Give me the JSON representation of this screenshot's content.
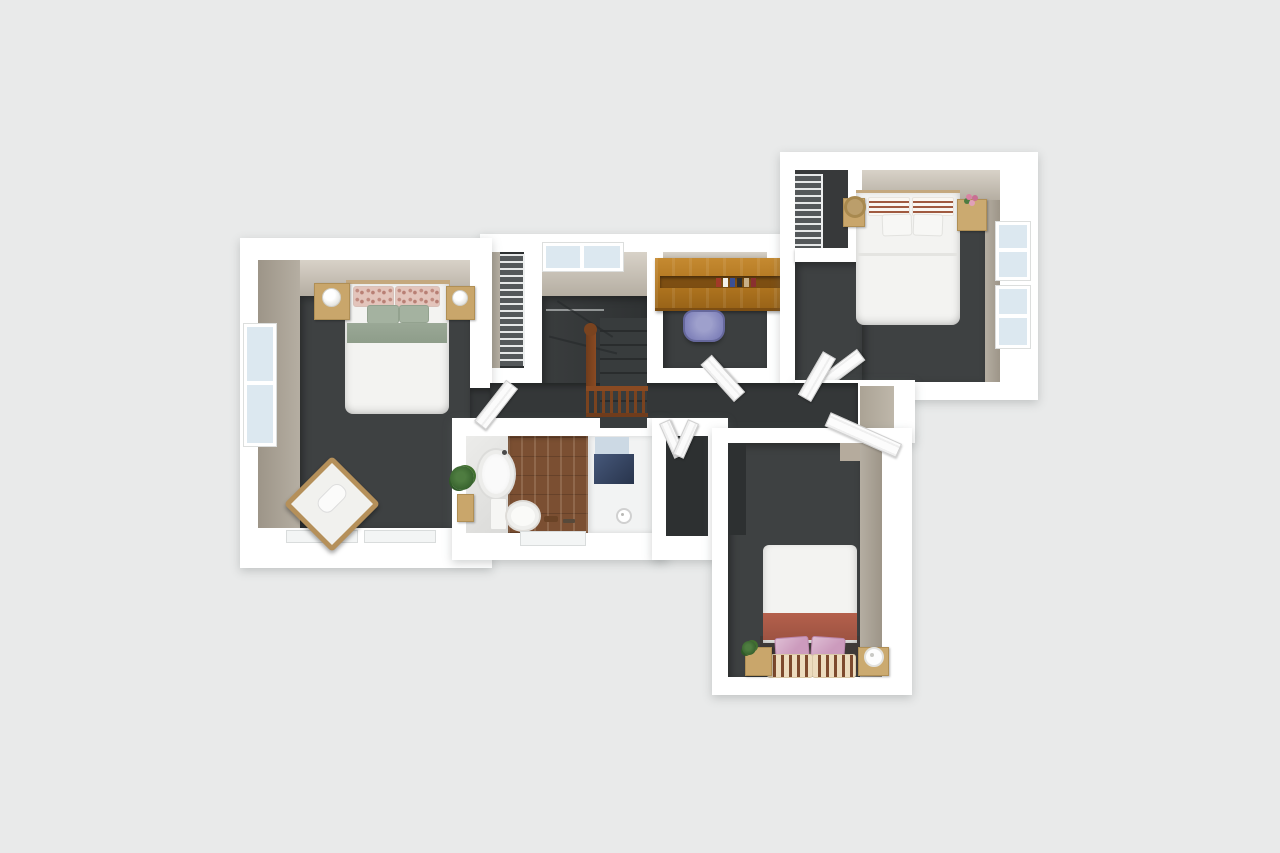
{
  "canvas": {
    "width": 1280,
    "height": 853
  },
  "scene": {
    "type": "3d-floor-plan-render",
    "view": "top-down dollhouse",
    "rooms": [
      {
        "name": "master-bedroom",
        "floor": "dark-charcoal-carpet",
        "windows": 2,
        "furniture": [
          "double-bed-white-duvet",
          "sage-green-blanket",
          "two-floral-pillows",
          "two-sage-pillows",
          "nightstand-with-lamp-left",
          "nightstand-with-lamp-right",
          "wood-frame-armchair",
          "plant-on-console"
        ]
      },
      {
        "name": "landing-closet",
        "floor": "dark-carpet",
        "windows": 0,
        "furniture": [
          "wire-shelving-unit"
        ]
      },
      {
        "name": "stair-landing",
        "floor": "dark-charcoal-carpet",
        "windows": 1,
        "furniture": [
          "winder-staircase",
          "wood-newel-post",
          "wood-banister"
        ]
      },
      {
        "name": "office",
        "floor": "dark-charcoal-carpet",
        "windows": 0,
        "furniture": [
          "wood-desk",
          "desk-shelf-books",
          "purple-tub-chair"
        ]
      },
      {
        "name": "bedroom-2",
        "floor": "dark-charcoal-carpet",
        "windows": 2,
        "furniture": [
          "double-bed-white-duvet",
          "two-rust-striped-pillows",
          "two-white-pillows",
          "nightstand-with-basket",
          "dresser-with-pink-flowers",
          "wire-shelving-closet"
        ]
      },
      {
        "name": "hallway",
        "floor": "dark-charcoal-carpet",
        "windows": 0,
        "furniture": [
          "open-doors"
        ]
      },
      {
        "name": "bathroom",
        "floor": "wood-plank",
        "windows": 1,
        "furniture": [
          "corner-sink",
          "toilet",
          "walk-in-shower-glass"
        ]
      },
      {
        "name": "airing-cupboard",
        "floor": "dark-carpet",
        "windows": 0,
        "furniture": [
          "double-doors"
        ]
      },
      {
        "name": "bedroom-3",
        "floor": "dark-charcoal-carpet",
        "windows": 0,
        "furniture": [
          "double-bed-white-duvet",
          "terracotta-bed-runner",
          "two-pink-pillows",
          "two-striped-pillows",
          "nightstand-with-plant",
          "nightstand-with-round-lamp",
          "dark-headboard"
        ]
      }
    ]
  },
  "colors": {
    "background": "#e9eaea",
    "wall": "#ffffff",
    "wall_face": "#b5aea2",
    "wall_face_light": "#d8d2c8",
    "wall_face_dark": "#9d9588",
    "carpet": "#3e4142",
    "carpet_dark": "#2d3031",
    "hall_carpet": "#343738",
    "wood_floor": "#7b4f32",
    "desk_wood": "#b0751f",
    "desk_shadow": "#7d4e12",
    "banister": "#7a431f",
    "sage": "#9aa896",
    "sage_pillow": "#a4b2a0",
    "floral": "#e3c4bb",
    "floral_dot": "#c08b80",
    "linen": "#f3f3f1",
    "terracotta": "#9d5342",
    "pink_pillow": "#cc9bbd",
    "stripe_cream": "#ecdcbf",
    "stripe_brown": "#7d4a2e",
    "bed_stripe_rust": "#a05a40",
    "chair_purple": "#8183bb",
    "chair_purple_dark": "#66689c",
    "nightstand": "#c9a66b",
    "nightstand_edge": "#b08f55",
    "glass": "#dce8f0",
    "glass_dark": "#28344c",
    "plant": "#4e7c40",
    "headboard_tan": "#c4a87e",
    "headboard_dark": "#3f3937",
    "wire_base": "#54585a",
    "wire_line": "#e6e8e8"
  }
}
